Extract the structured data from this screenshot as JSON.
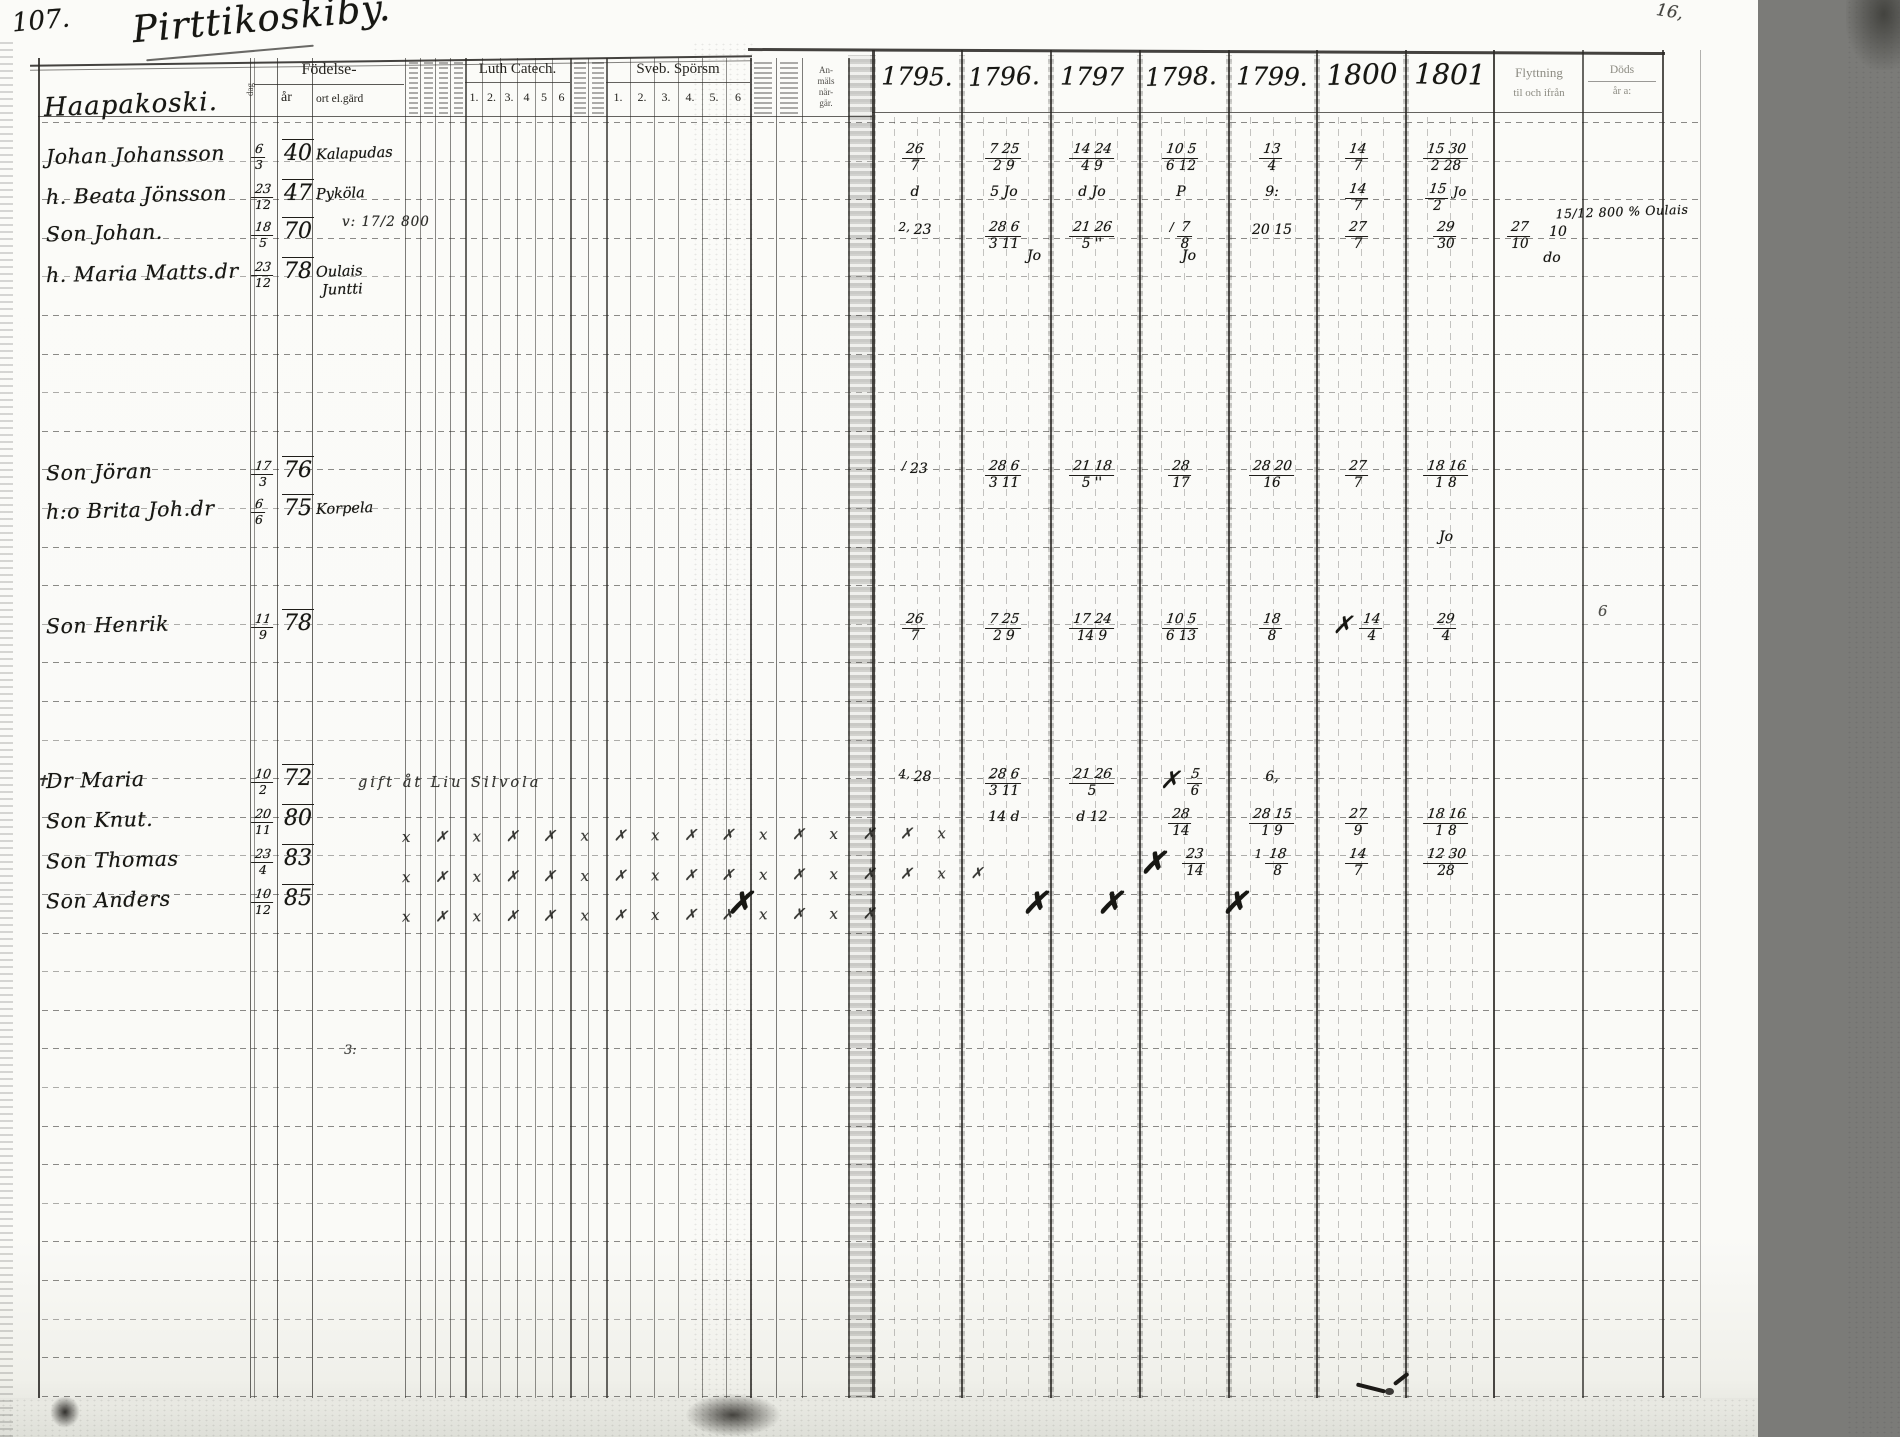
{
  "document": {
    "folio_number": "107.",
    "page_title": "Pirttikoskiby."
  },
  "left_page_header": {
    "birth_group_label": "Födelse-",
    "birth_day_label": "dag",
    "birth_year_label": "år",
    "birth_place_label": "ort el.gärd",
    "luth_catech_label": "Luth Catech.",
    "luth_catech_numbers": [
      "1.",
      "2.",
      "3.",
      "4",
      "5",
      "6"
    ],
    "sporsm_label": "Sveb. Spörsm",
    "sporsm_numbers": [
      "1.",
      "2.",
      "3.",
      "4.",
      "5.",
      "6"
    ],
    "anmals_lines": [
      "An-",
      "mäls",
      "när-",
      "gär."
    ]
  },
  "right_page_header": {
    "years": [
      "1795.",
      "1796.",
      "1797",
      "1798.",
      "1799.",
      "1800",
      "1801"
    ],
    "flyttning_line1": "Flyttning",
    "flyttning_line2": "til och ifrån",
    "dod_line1": "Döds",
    "dod_line2": "år a:"
  },
  "margin_notes": {
    "top_right_mark": "16,",
    "right_edge_mark": "6",
    "stray_mark": "3:"
  },
  "rows": [
    {
      "kind": "farm",
      "name": "Haapakoski.",
      "marks": []
    },
    {
      "kind": "person",
      "name": "Johan Johansson",
      "day": "6",
      "mon": "3",
      "year": "40",
      "place": "Kalapudas",
      "marks": [
        {
          "col": "1795",
          "t": "26",
          "b": "7"
        },
        {
          "col": "1796",
          "t": "7 25",
          "b": "2 9"
        },
        {
          "col": "1797",
          "t": "14 24",
          "b": "4 9"
        },
        {
          "col": "1798",
          "t": "10 5",
          "b": "6 12"
        },
        {
          "col": "1799",
          "t": "13",
          "b": "4"
        },
        {
          "col": "1800",
          "t": "14",
          "b": "7"
        },
        {
          "col": "1801",
          "t": "15 30",
          "b": "2 28"
        }
      ]
    },
    {
      "kind": "person",
      "name": "h. Beata Jönsson",
      "day": "23",
      "mon": "12",
      "year": "47",
      "place": "Pyköla",
      "marks": [
        {
          "col": "1795",
          "v": "d"
        },
        {
          "col": "1796",
          "v": "5 Jo"
        },
        {
          "col": "1797",
          "v": "d Jo"
        },
        {
          "col": "1798",
          "v": "P"
        },
        {
          "col": "1799",
          "v": "9:"
        },
        {
          "col": "1800",
          "t": "14",
          "b": "7"
        },
        {
          "col": "1801",
          "t": "15",
          "b": "2",
          "s": "Jo"
        }
      ]
    },
    {
      "kind": "person",
      "name": "Son Johan.",
      "day": "18",
      "mon": "5",
      "year": "70",
      "note_catech": "v: 17/2 800",
      "marks": [
        {
          "col": "1795",
          "v": "23",
          "p": "2,"
        },
        {
          "col": "1796",
          "t": "28 6",
          "b": "3 11"
        },
        {
          "col": "1796",
          "v": "Jo",
          "dx": 30,
          "dy": 26
        },
        {
          "col": "1797",
          "t": "21 26",
          "b": "5 ''"
        },
        {
          "col": "1798",
          "t": "7",
          "b": "8",
          "p": "/"
        },
        {
          "col": "1798",
          "v": "Jo",
          "dx": 8,
          "dy": 26
        },
        {
          "col": "1799",
          "v": "20 15"
        },
        {
          "col": "1800",
          "t": "27",
          "b": "7"
        },
        {
          "col": "1801",
          "t": "29",
          "b": "30"
        },
        {
          "col": "flytt",
          "t": "27",
          "b": "10",
          "dx": -12
        },
        {
          "col": "flytt",
          "v": "10",
          "dx": 26,
          "dy": 2
        },
        {
          "col": "flytt",
          "v": "do",
          "dx": 20,
          "dy": 28
        },
        {
          "col": "dod",
          "v": "15/12 800 % Oulais",
          "wide": true,
          "dx": 10,
          "dy": -16
        }
      ]
    },
    {
      "kind": "person",
      "name": "h. Maria Matts.dr",
      "day": "23",
      "mon": "12",
      "year": "78",
      "place": "Oulais",
      "place2": "Juntti",
      "marks": []
    },
    {
      "kind": "person",
      "name": "Son Jöran",
      "day": "17",
      "mon": "3",
      "year": "76",
      "marks": [
        {
          "col": "1795",
          "v": "23",
          "p": "/"
        },
        {
          "col": "1796",
          "t": "28 6",
          "b": "3 11"
        },
        {
          "col": "1797",
          "t": "21 18",
          "b": "5 ''"
        },
        {
          "col": "1798",
          "t": "28",
          "b": "17"
        },
        {
          "col": "1799",
          "t": "28 20",
          "b": "16"
        },
        {
          "col": "1800",
          "t": "27",
          "b": "7"
        },
        {
          "col": "1801",
          "t": "18 16",
          "b": "1 8"
        }
      ]
    },
    {
      "kind": "person",
      "name": "h:o Brita Joh.dr",
      "day": "6",
      "mon": "6",
      "year": "75",
      "place": "Korpela",
      "marks": [
        {
          "col": "1801",
          "v": "Jo",
          "dy": 30
        }
      ]
    },
    {
      "kind": "person",
      "name": "Son Henrik",
      "day": "11",
      "mon": "9",
      "year": "78",
      "marks": [
        {
          "col": "1795",
          "t": "26",
          "b": "7"
        },
        {
          "col": "1796",
          "t": "7 25",
          "b": "2 9"
        },
        {
          "col": "1797",
          "t": "17 24",
          "b": "14 9"
        },
        {
          "col": "1798",
          "t": "10 5",
          "b": "6 13"
        },
        {
          "col": "1799",
          "t": "18",
          "b": "8"
        },
        {
          "col": "1800",
          "t": "14",
          "b": "4",
          "p": "✗"
        },
        {
          "col": "1801",
          "t": "29",
          "b": "4"
        }
      ]
    },
    {
      "kind": "person",
      "name": "Dr Maria",
      "prefix": "✝",
      "day": "10",
      "mon": "2",
      "year": "72",
      "note_right": "gift åt Liu Silvola",
      "marks": [
        {
          "col": "1795",
          "v": "28",
          "p": "4,"
        },
        {
          "col": "1796",
          "t": "28 6",
          "b": "3 11"
        },
        {
          "col": "1797",
          "t": "21 26",
          "b": "5"
        },
        {
          "col": "1798",
          "t": "5",
          "b": "6",
          "p": "✗"
        },
        {
          "col": "1799",
          "v": "6,"
        }
      ]
    },
    {
      "kind": "person",
      "name": "Son Knut.",
      "day": "20",
      "mon": "11",
      "year": "80",
      "xrow": 16,
      "marks": [
        {
          "col": "1796",
          "v": "14 d"
        },
        {
          "col": "1797",
          "v": "d 12"
        },
        {
          "col": "1798",
          "t": "28",
          "b": "14"
        },
        {
          "col": "1799",
          "t": "28 15",
          "b": "1 9"
        },
        {
          "col": "1800",
          "t": "27",
          "b": "9"
        },
        {
          "col": "1801",
          "t": "18 16",
          "b": "1 8"
        }
      ]
    },
    {
      "kind": "person",
      "name": "Son Thomas",
      "day": "23",
      "mon": "4",
      "year": "83",
      "xrow": 17,
      "marks": [
        {
          "col": "1798",
          "v": "✗",
          "big": true,
          "dx": -28
        },
        {
          "col": "1798",
          "t": "23",
          "b": "14",
          "dx": 14
        },
        {
          "col": "1799",
          "t": "18",
          "b": "8",
          "p": "1"
        },
        {
          "col": "1800",
          "t": "14",
          "b": "7"
        },
        {
          "col": "1801",
          "t": "12 30",
          "b": "28"
        }
      ]
    },
    {
      "kind": "person",
      "name": "Son Anders",
      "day": "10",
      "mon": "12",
      "year": "85",
      "xrow": 14,
      "marks": [
        {
          "col": "1795",
          "v": "✗",
          "big": true,
          "dx": -175
        },
        {
          "col": "1797",
          "v": "✗",
          "big": true,
          "dx": -57
        },
        {
          "col": "1797",
          "v": "✗",
          "big": true,
          "dx": 18
        },
        {
          "col": "1799",
          "v": "✗",
          "big": true,
          "dx": -37
        }
      ]
    }
  ]
}
